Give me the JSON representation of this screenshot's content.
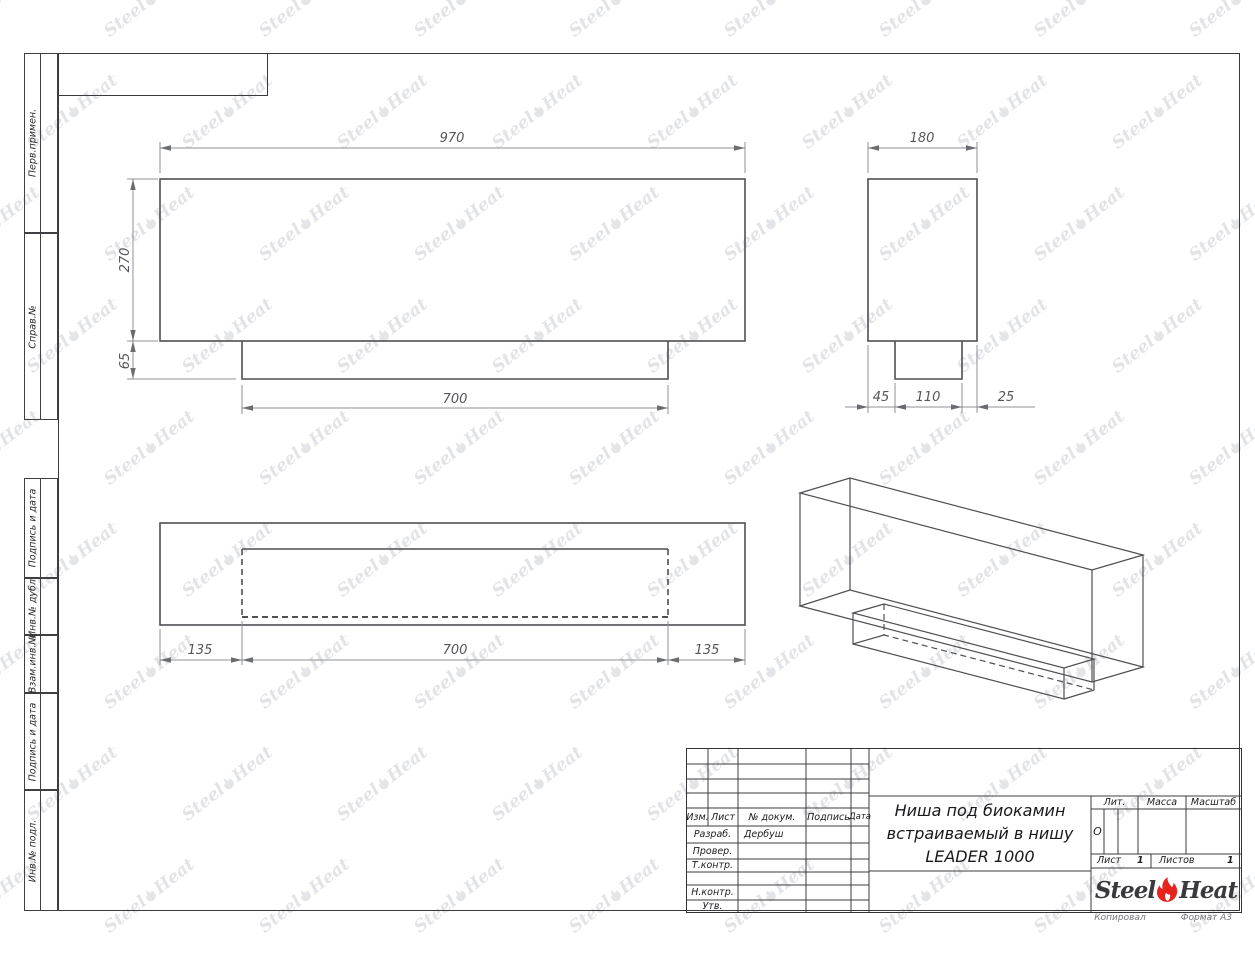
{
  "margin_labels": [
    "Перв.примен.",
    "Справ.№",
    "Подпись и дата",
    "Инв.№ дубл.",
    "Взам.инв.№",
    "Подпись и дата",
    "Инв.№ подл."
  ],
  "title_block": {
    "header": {
      "izm": "Изм.",
      "list": "Лист",
      "doc": "№ докум.",
      "sign": "Подпись",
      "date": "Дата"
    },
    "rows": [
      {
        "label": "Разраб.",
        "value": "Дербуш"
      },
      {
        "label": "Провер.",
        "value": ""
      },
      {
        "label": "Т.контр.",
        "value": ""
      },
      {
        "label": "Н.контр.",
        "value": ""
      },
      {
        "label": "Утв.",
        "value": ""
      }
    ],
    "title_lines": [
      "Ниша под биокамин",
      "встраиваемый в нишу",
      "LEADER 1000"
    ],
    "lit_label": "Лит.",
    "lit_value": "О",
    "mass_label": "Масса",
    "scale_label": "Масштаб",
    "sheet_label": "Лист",
    "sheet_value": "1",
    "sheets_label": "Листов",
    "sheets_value": "1"
  },
  "logo": {
    "steel": "Steel",
    "heat": "Heat"
  },
  "watermark": {
    "steel": "Steel",
    "heat": "Heat"
  },
  "footer": {
    "copied": "Копировал",
    "format": "Формат А3"
  },
  "drawing": {
    "front_view": {
      "width": "970",
      "height": "270",
      "step_height": "65",
      "step_width": "700"
    },
    "side_view": {
      "depth": "180",
      "front_offset": "45",
      "step_depth": "110",
      "back_offset": "25"
    },
    "bottom_view": {
      "left_margin": "135",
      "opening_width": "700",
      "right_margin": "135"
    }
  },
  "colors": {
    "accent_red": "#e8231e",
    "line": "#4f4f54",
    "watermark": "#e2e3e6"
  }
}
